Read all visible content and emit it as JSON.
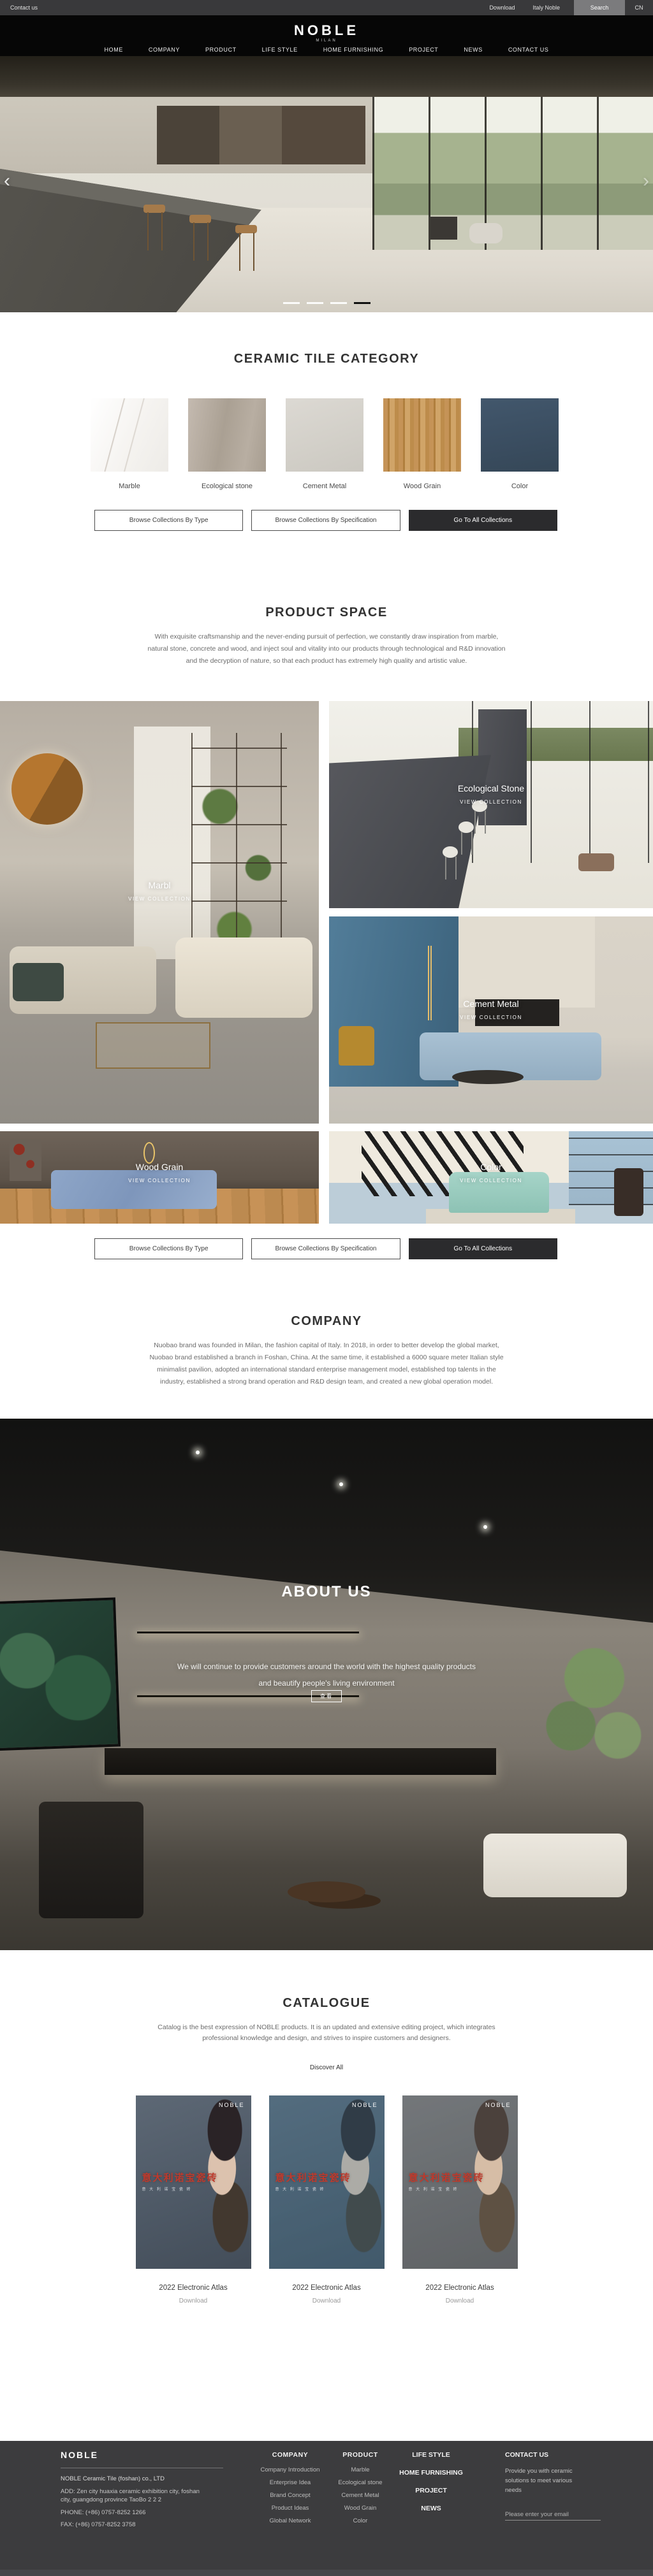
{
  "topbar": {
    "contact_us": "Contact us",
    "download": "Download",
    "italy_noble": "Italy Noble",
    "search": "Search",
    "lang": "CN"
  },
  "header": {
    "logo": "NOBLE",
    "logo_subtitle": "MILAN",
    "nav": {
      "home": "HOME",
      "company": "COMPANY",
      "product": "PRODUCT",
      "life_style": "LIFE STYLE",
      "home_furnishing": "HOME FURNISHING",
      "project": "PROJECT",
      "news": "NEWS",
      "contact_us": "CONTACT US"
    }
  },
  "hero": {
    "prev_arrow": "‹",
    "next_arrow": "›"
  },
  "category": {
    "title": "CERAMIC TILE CATEGORY",
    "items": {
      "marble": "Marble",
      "eco": "Ecological stone",
      "cement": "Cement Metal",
      "wood": "Wood Grain",
      "color": "Color"
    },
    "buttons": {
      "by_type": "Browse Collections By Type",
      "by_spec": "Browse Collections By Specification",
      "all": "Go To All Collections"
    }
  },
  "product_space": {
    "title": "PRODUCT SPACE",
    "line1": "With exquisite craftsmanship and the never-ending pursuit of perfection, we constantly draw inspiration from marble,",
    "line2": "natural stone, concrete and wood, and inject soul and vitality into our products through technological and R&D innovation",
    "line3": "and the decryption of nature, so that each product has extremely high quality and artistic value.",
    "view_collection": "VIEW COLLECTION",
    "tiles": {
      "marble": "Marbl",
      "eco": "Ecological Stone",
      "cement": "Cement Metal",
      "wood": "Wood Grain",
      "color": "Color"
    }
  },
  "company": {
    "title": "COMPANY",
    "line1": "Nuobao brand was founded in Milan, the fashion capital of Italy. In 2018, in order to better develop the global market,",
    "line2": "Nuobao brand established a branch in Foshan, China. At the same time, it established a 6000 square meter Italian style",
    "line3": "minimalist pavilion, adopted an international standard enterprise management model, established top talents in the",
    "line4": "industry, established a strong brand operation and R&D design team, and created a new global operation model."
  },
  "about": {
    "title": "ABOUT US",
    "line1": "We will continue to provide customers around the world with the highest quality products",
    "line2": "and beautify people's living environment",
    "more": "查看"
  },
  "catalogue": {
    "title": "CATALOGUE",
    "line1": "Catalog is the best expression of NOBLE products. It is an updated and extensive editing project, which integrates",
    "line2": "professional knowledge and design, and strives to inspire customers and designers.",
    "discover": "Discover All",
    "cover_brand": "NOBLE",
    "cover_title": "意大利诺宝瓷砖",
    "cover_subtitle": "意 大 利 诺 宝 瓷 砖",
    "item_title": "2022 Electronic Atlas",
    "download": "Download"
  },
  "footer": {
    "logo": "NOBLE",
    "company_name": "NOBLE Ceramic Tile (foshan) co., LTD",
    "address_line1": "ADD:  Zen city huaxia ceramic exhibition city, foshan",
    "address_line2": "city, guangdong province TaoBo 2 2 2",
    "phone": "PHONE:   (+86)  0757-8252 1266",
    "fax": "FAX:   (+86)  0757-8252 3758",
    "col_company": {
      "title": "COMPANY",
      "items": {
        "intro": "Company Introduction",
        "idea": "Enterprise Idea",
        "brand": "Brand Concept",
        "product": "Product Ideas",
        "network": "Global Network"
      }
    },
    "col_product": {
      "title": "PRODUCT",
      "items": {
        "marble": "Marble",
        "eco": "Ecological stone",
        "cement": "Cement Metal",
        "wood": "Wood Grain",
        "color": "Color"
      }
    },
    "col_links": {
      "life_style": "LIFE STYLE",
      "home_furnishing": "HOME FURNISHING",
      "project": "PROJECT",
      "news": "NEWS"
    },
    "col_contact": {
      "title": "CONTACT US",
      "blurb1": "Provide you with ceramic",
      "blurb2": "solutions to meet various",
      "blurb3": "needs",
      "placeholder": "Please enter your email"
    }
  },
  "colors": {
    "accent_red": "#c0392b",
    "dark_button": "#2b2b2d",
    "footer_bg": "#3c3c3e",
    "header_bg": "#060606"
  }
}
